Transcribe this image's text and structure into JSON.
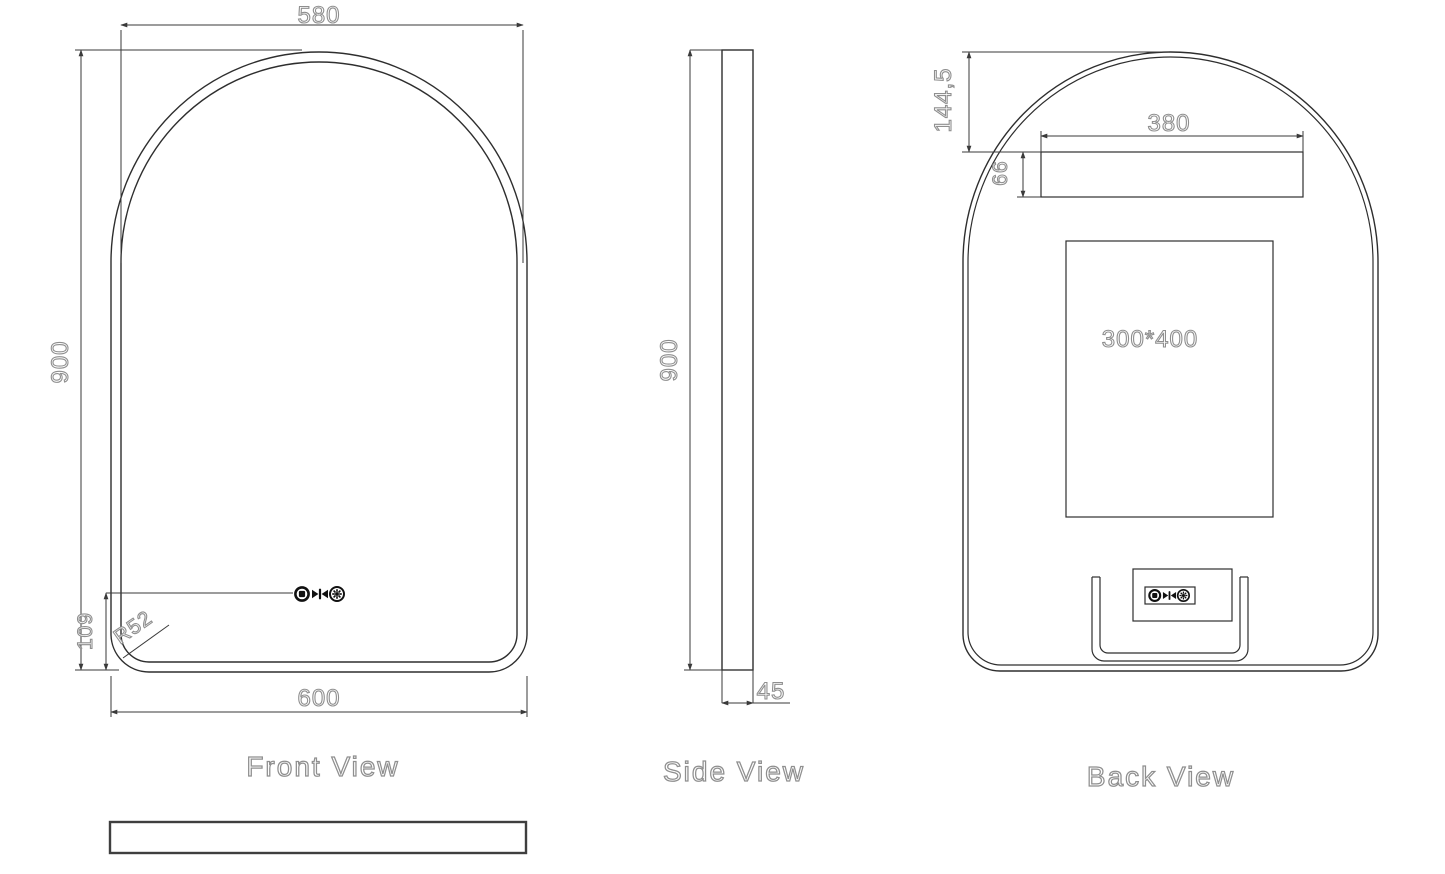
{
  "drawing_type": "mirror-technical-drawing",
  "colors": {
    "background": "#ffffff",
    "line": "#3a3a3a",
    "text_outline": "#8f8f8f"
  },
  "front_view": {
    "label": "Front View",
    "dim_top_width": "580",
    "dim_height": "900",
    "dim_bottom_width": "600",
    "dim_buttons_offset": "109",
    "dim_corner_radius": "R52"
  },
  "side_view": {
    "label": "Side View",
    "dim_height": "900",
    "dim_thickness": "45"
  },
  "back_view": {
    "label": "Back View",
    "dim_top_to_bracket": "144,5",
    "dim_bracket_width": "380",
    "dim_bracket_height": "66",
    "dim_junction_plate": "300*400"
  },
  "control_icons": [
    "power-touch-icon",
    "defog-touch-icon",
    "brightness-touch-icon"
  ]
}
